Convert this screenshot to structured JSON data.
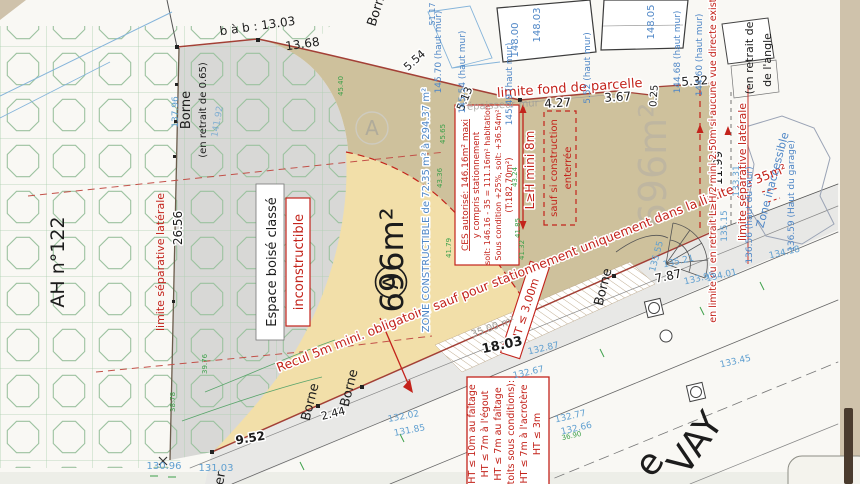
{
  "palette": {
    "page_bg": "#cfc2ab",
    "paper": "#f9f8f4",
    "tan_zone": "#cec19c",
    "cream_zone": "#f2dfa9",
    "ebc_gray": "#d8d8d6",
    "pattern_green": "#9cc2a0",
    "road_gray": "#e8e8e6",
    "boundary_red": "#a34036",
    "annotation_red": "#c3231b",
    "level_blue": "#4e86c6",
    "survey_green": "#3da04a"
  },
  "parcel": {
    "letter": "A",
    "area": "696m²",
    "neighbor_area": "696m²"
  },
  "boxes": {
    "ebc": {
      "line1": "Espace boisé classé",
      "line2": "inconstructible"
    },
    "ces": {
      "l1": "CES autorisé: 146.16m² maxi",
      "l2": "y compris stationnement",
      "l3": "soit: 146.16 - 35 = 111.16m² habitation",
      "l4": "Sous condition +25%, soit: +36.54m²",
      "l5": "(T:182.70m²)"
    },
    "enterree": {
      "l1": "sauf si construction",
      "l2": "enterrée"
    },
    "heights": {
      "l1": "HT ≤ 10m au faîtage",
      "l2": "HT ≤ 7m à l'égout",
      "l3": "HT ≤ 7m au faîtage",
      "l4": "(toits sous conditions):",
      "l5": "HT ≤ 7m à l'acrotère",
      "l6": "HT ≤ 3m"
    },
    "ht3": "HT ≤ 3.00m"
  },
  "labels": [
    {
      "t": "b à b : 13.03",
      "x": 258,
      "y": 30,
      "r": -8,
      "s": 12,
      "c": "ink",
      "n": "dim-bab-13-03"
    },
    {
      "t": "13.68",
      "x": 303,
      "y": 48,
      "r": -8,
      "s": 12,
      "c": "ink",
      "n": "dim-13-68"
    },
    {
      "t": "5.54",
      "x": 417,
      "y": 63,
      "r": -42,
      "s": 11,
      "c": "ink",
      "h": 1,
      "n": "dim-5-54"
    },
    {
      "t": "5.13",
      "x": 468,
      "y": 100,
      "r": -68,
      "s": 11,
      "c": "ink",
      "h": 1,
      "n": "dim-5-13"
    },
    {
      "t": "4.27",
      "x": 558,
      "y": 107,
      "r": -4,
      "s": 12,
      "c": "ink",
      "h": 1,
      "n": "dim-4-27"
    },
    {
      "t": "3.67",
      "x": 618,
      "y": 101,
      "r": -4,
      "s": 12,
      "c": "ink",
      "h": 1,
      "n": "dim-3-67"
    },
    {
      "t": "0.25",
      "x": 657,
      "y": 96,
      "r": -86,
      "s": 10,
      "c": "ink",
      "h": 1,
      "n": "dim-0-25"
    },
    {
      "t": "5.32",
      "x": 695,
      "y": 85,
      "r": -4,
      "s": 12,
      "c": "ink",
      "h": 1,
      "n": "dim-5-32"
    },
    {
      "t": "11.99",
      "x": 722,
      "y": 168,
      "r": -90,
      "s": 12,
      "c": "ink",
      "h": 1,
      "n": "dim-11-99"
    },
    {
      "t": "26.56",
      "x": 182,
      "y": 228,
      "r": -90,
      "s": 12,
      "c": "ink",
      "h": 1,
      "n": "dim-26-56"
    },
    {
      "t": "Borne",
      "x": 190,
      "y": 110,
      "r": -90,
      "s": 13,
      "c": "ink",
      "n": "borne-label"
    },
    {
      "t": "(en retrait de 0.65)",
      "x": 206,
      "y": 110,
      "r": -90,
      "s": 10,
      "c": "ink",
      "n": "borne-retrait-label"
    },
    {
      "t": "Borne",
      "x": 381,
      "y": 9,
      "r": -72,
      "s": 13,
      "c": "ink",
      "n": "borne-label"
    },
    {
      "t": "AH n°122",
      "x": 64,
      "y": 262,
      "r": -90,
      "s": 19,
      "c": "ink",
      "n": "parcel-id-ah122"
    },
    {
      "t": "9.52",
      "x": 251,
      "y": 442,
      "r": -10,
      "s": 12,
      "c": "ink",
      "b": 1,
      "h": 1,
      "n": "dim-9-52"
    },
    {
      "t": "2.44",
      "x": 334,
      "y": 417,
      "r": -14,
      "s": 11,
      "c": "ink",
      "h": 1,
      "n": "dim-2-44"
    },
    {
      "t": "Borne",
      "x": 314,
      "y": 403,
      "r": -76,
      "s": 13,
      "c": "ink",
      "n": "borne-label"
    },
    {
      "t": "Borne",
      "x": 353,
      "y": 389,
      "r": -76,
      "s": 13,
      "c": "ink",
      "n": "borne-label"
    },
    {
      "t": "18.03",
      "x": 503,
      "y": 349,
      "r": -12,
      "s": 13,
      "c": "ink",
      "b": 1,
      "h": 1,
      "n": "dim-18-03"
    },
    {
      "t": "7.87",
      "x": 669,
      "y": 280,
      "r": -12,
      "s": 12,
      "c": "ink",
      "h": 1,
      "n": "dim-7-87"
    },
    {
      "t": "Borne",
      "x": 607,
      "y": 288,
      "r": -76,
      "s": 13,
      "c": "ink",
      "n": "borne-label"
    },
    {
      "t": "(en retrait de",
      "x": 753,
      "y": 58,
      "r": -90,
      "s": 11,
      "c": "ink",
      "n": "retrait-angle-label"
    },
    {
      "t": "de l'angle",
      "x": 771,
      "y": 60,
      "r": -90,
      "s": 11,
      "c": "ink",
      "n": "retrait-angle-label"
    },
    {
      "t": "e",
      "x": 659,
      "y": 470,
      "r": -55,
      "s": 36,
      "c": "ink",
      "n": "street-name-fragment"
    },
    {
      "t": "VAY",
      "x": 705,
      "y": 450,
      "r": -55,
      "s": 36,
      "c": "ink",
      "n": "street-name-fragment"
    },
    {
      "t": "er",
      "x": 224,
      "y": 479,
      "r": -80,
      "s": 13,
      "c": "ink",
      "n": "street-name-fragment"
    },
    {
      "t": "limite séparative latérale",
      "x": 164,
      "y": 262,
      "r": -90,
      "s": 11,
      "c": "red",
      "n": "limite-separative-left"
    },
    {
      "t": "limite fond de parcelle",
      "x": 570,
      "y": 92,
      "r": -4,
      "s": 13,
      "c": "red",
      "h": 1,
      "n": "limite-fond-parcelle"
    },
    {
      "t": "Recul 5m mini. obligatoire sauf pour stationnement uniquement dans la limite de 35m²",
      "x": 533,
      "y": 272,
      "r": -21.5,
      "s": 12.5,
      "c": "red",
      "h": 1,
      "n": "recul-rule"
    },
    {
      "t": "L≥H mini 8m",
      "x": 534,
      "y": 170,
      "r": -90,
      "s": 12,
      "c": "red",
      "h": 1,
      "n": "lh-mini-8m-rule"
    },
    {
      "t": "en limite ou en retrait L≥H/2 mini 2.50m si aucune vue directe existante",
      "x": 716,
      "y": 150,
      "r": -90,
      "s": 9.5,
      "c": "red",
      "h": 1,
      "n": "lh2-rule"
    },
    {
      "t": "limite séparative latérale",
      "x": 746,
      "y": 172,
      "r": -90,
      "s": 11,
      "c": "red",
      "h": 1,
      "n": "limite-separative-right"
    },
    {
      "t": "ZONE CONSTRUCTIBLE de 72.35 m² à 294.37 m²",
      "x": 429,
      "y": 210,
      "r": -90,
      "s": 10,
      "c": "blue",
      "h": 1,
      "n": "zone-constructible-label"
    },
    {
      "t": "51.17",
      "x": 435,
      "y": 14,
      "r": -90,
      "s": 8,
      "c": "blue",
      "n": "level-51-17"
    },
    {
      "t": "148.00",
      "x": 518,
      "y": 40,
      "r": -90,
      "s": 10,
      "c": "blue",
      "n": "level-148-00"
    },
    {
      "t": "148.03",
      "x": 540,
      "y": 25,
      "r": -90,
      "s": 10,
      "c": "blue",
      "n": "level-148-03"
    },
    {
      "t": "148.05",
      "x": 654,
      "y": 22,
      "r": -90,
      "s": 10,
      "c": "blue",
      "n": "level-148-05"
    },
    {
      "t": "145.70 (haut mur)",
      "x": 441,
      "y": 52,
      "r": -90,
      "s": 9,
      "c": "blue",
      "n": "level-haut-mur"
    },
    {
      "t": "145.54 (haut mur)",
      "x": 465,
      "y": 72,
      "r": -90,
      "s": 9,
      "c": "blue",
      "n": "level-haut-mur"
    },
    {
      "t": "145.49 (haut mur)",
      "x": 512,
      "y": 84,
      "r": -90,
      "s": 9,
      "c": "blue",
      "n": "level-haut-mur"
    },
    {
      "t": "5.52 (haut mur)",
      "x": 590,
      "y": 68,
      "r": -90,
      "s": 9,
      "c": "blue",
      "n": "level-haut-mur"
    },
    {
      "t": "144.68 (haut mur)",
      "x": 680,
      "y": 52,
      "r": -90,
      "s": 9,
      "c": "blue",
      "n": "level-haut-mur"
    },
    {
      "t": "144.60 (haut mur)",
      "x": 702,
      "y": 55,
      "r": -90,
      "s": 9,
      "c": "blue",
      "n": "level-haut-mur"
    },
    {
      "t": "137.96",
      "x": 178,
      "y": 112,
      "r": -90,
      "s": 9,
      "c": "cyan",
      "n": "level-137-96"
    },
    {
      "t": "141.92",
      "x": 220,
      "y": 122,
      "r": -80,
      "s": 9,
      "c": "cyan",
      "o": 0.7,
      "n": "level-141-92"
    },
    {
      "t": "135.15",
      "x": 727,
      "y": 226,
      "r": -90,
      "s": 9,
      "c": "cyan",
      "n": "level-135-15"
    },
    {
      "t": "133.31",
      "x": 739,
      "y": 181,
      "r": -90,
      "s": 9,
      "c": "cyan",
      "n": "level-133-31"
    },
    {
      "t": "136.56 (haut du mur)",
      "x": 752,
      "y": 215,
      "r": -90,
      "s": 9,
      "c": "blue",
      "n": "level-haut-mur"
    },
    {
      "t": "136.59 (Haut du garage)",
      "x": 794,
      "y": 196,
      "r": -90,
      "s": 9,
      "c": "blue",
      "n": "level-haut-garage"
    },
    {
      "t": "Zone inaccessible",
      "x": 776,
      "y": 181,
      "r": -75,
      "s": 11,
      "c": "blue",
      "n": "zone-inaccessible-label"
    },
    {
      "t": "135.55",
      "x": 659,
      "y": 257,
      "r": -75,
      "s": 9,
      "c": "cyan",
      "n": "road-level"
    },
    {
      "t": "135.21",
      "x": 679,
      "y": 264,
      "r": -13,
      "s": 9,
      "c": "cyan",
      "n": "road-level"
    },
    {
      "t": "133.95",
      "x": 700,
      "y": 281,
      "r": -13,
      "s": 9,
      "c": "cyan",
      "n": "road-level"
    },
    {
      "t": "134.01",
      "x": 722,
      "y": 278,
      "r": -13,
      "s": 9,
      "c": "cyan",
      "n": "road-level"
    },
    {
      "t": "134.18",
      "x": 785,
      "y": 255,
      "r": -13,
      "s": 9,
      "c": "cyan",
      "n": "road-level"
    },
    {
      "t": "133.45",
      "x": 736,
      "y": 364,
      "r": -13,
      "s": 9,
      "c": "cyan",
      "n": "road-level"
    },
    {
      "t": "132.87",
      "x": 544,
      "y": 351,
      "r": -13,
      "s": 9,
      "c": "cyan",
      "n": "road-level"
    },
    {
      "t": "132.67",
      "x": 529,
      "y": 375,
      "r": -13,
      "s": 9,
      "c": "cyan",
      "n": "road-level"
    },
    {
      "t": "132.77",
      "x": 571,
      "y": 419,
      "r": -13,
      "s": 9,
      "c": "cyan",
      "n": "road-level"
    },
    {
      "t": "132.66",
      "x": 577,
      "y": 431,
      "r": -13,
      "s": 9,
      "c": "cyan",
      "n": "road-level"
    },
    {
      "t": "132.02",
      "x": 404,
      "y": 419,
      "r": -11,
      "s": 9,
      "c": "cyan",
      "n": "road-level"
    },
    {
      "t": "131.85",
      "x": 410,
      "y": 433,
      "r": -11,
      "s": 9,
      "c": "cyan",
      "n": "road-level"
    },
    {
      "t": "130.96",
      "x": 164,
      "y": 469,
      "r": 0,
      "s": 10,
      "c": "cyan",
      "n": "road-level"
    },
    {
      "t": "131.03",
      "x": 216,
      "y": 471,
      "r": 0,
      "s": 10,
      "c": "cyan",
      "n": "road-level"
    },
    {
      "t": "45.40",
      "x": 343,
      "y": 86,
      "r": -90,
      "s": 7,
      "c": "green",
      "n": "survey-point"
    },
    {
      "t": "45.65",
      "x": 445,
      "y": 134,
      "r": -90,
      "s": 7,
      "c": "green",
      "n": "survey-point"
    },
    {
      "t": "43.36",
      "x": 442,
      "y": 178,
      "r": -90,
      "s": 7,
      "c": "green",
      "n": "survey-point"
    },
    {
      "t": "41.79",
      "x": 451,
      "y": 248,
      "r": -90,
      "s": 7,
      "c": "green",
      "n": "survey-point"
    },
    {
      "t": "43.24",
      "x": 517,
      "y": 177,
      "r": -90,
      "s": 7,
      "c": "green",
      "n": "survey-point"
    },
    {
      "t": "41.85",
      "x": 520,
      "y": 228,
      "r": -90,
      "s": 7,
      "c": "green",
      "n": "survey-point"
    },
    {
      "t": "41.32",
      "x": 524,
      "y": 250,
      "r": -90,
      "s": 7,
      "c": "green",
      "n": "survey-point"
    },
    {
      "t": "39.76",
      "x": 207,
      "y": 364,
      "r": -90,
      "s": 7,
      "c": "green",
      "n": "survey-point"
    },
    {
      "t": "38.78",
      "x": 175,
      "y": 402,
      "r": -90,
      "s": 7,
      "c": "green",
      "n": "survey-point"
    },
    {
      "t": "36.90",
      "x": 572,
      "y": 438,
      "r": -13,
      "s": 7,
      "c": "green",
      "n": "survey-point"
    },
    {
      "t": "35,00 m²",
      "x": 494,
      "y": 330,
      "r": -20,
      "s": 10,
      "c": "gray",
      "n": "parking-area-label"
    },
    {
      "t": "épaisseur mur",
      "x": 503,
      "y": 108,
      "r": -3,
      "s": 10,
      "c": "gray",
      "o": 0.8,
      "n": "wall-thickness-label"
    },
    {
      "t": "A",
      "x": 372,
      "y": 135,
      "r": 0,
      "s": 20,
      "c": "gray",
      "o": 0.6,
      "n": "parcel-letter-watermark"
    }
  ]
}
